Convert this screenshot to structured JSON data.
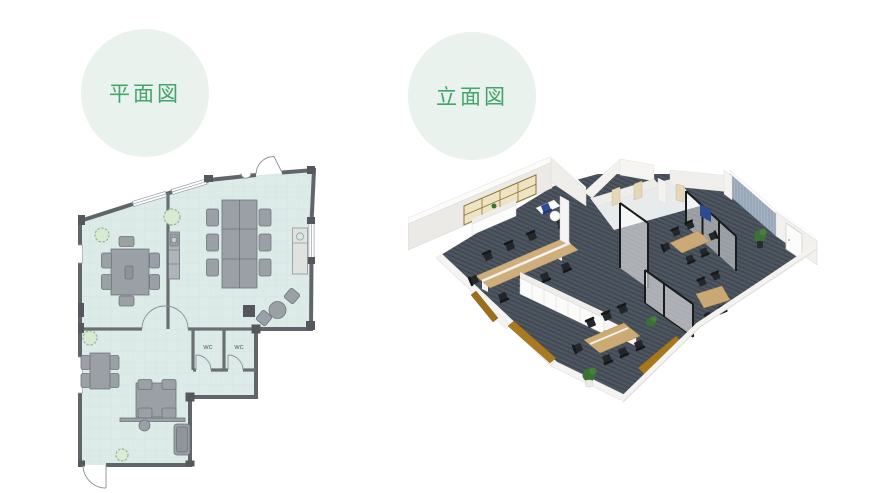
{
  "badges": {
    "bg_color": "#e9f2ed",
    "text_color": "#43a56b",
    "plan": {
      "label": "平面図"
    },
    "elevation": {
      "label": "立面図"
    }
  },
  "floor_plan": {
    "wc_label_1": "WC",
    "wc_label_2": "WC",
    "colors": {
      "floor": "#dcebe7",
      "grid": "#cfe2dd",
      "wall": "#60656a",
      "wall_nub": "#54585e",
      "furniture": "#9aa0a6",
      "furniture_outline": "#6e747a",
      "counter": "#dfe2df",
      "plant": "#d8ead2",
      "door_arc": "#8a9096"
    }
  },
  "elevation_view": {
    "colors": {
      "carpet": "#49525c",
      "carpet_streak": "#3e454e",
      "wall_face": "#eceae7",
      "wall_top": "#fbfbfa",
      "cabinet": "#fbfbfa",
      "wood_table": "#cfae7e",
      "window_frame": "#8e7330",
      "window_fill": "#eee3c4",
      "floor_panel_brown": "#a8761d",
      "glass_frame": "#1a1b1d",
      "accent_wall_blue": "#a5b4c4",
      "chair_black": "#23262b",
      "chair_blue": "#2e4d96",
      "plant_green": "#3c7035"
    }
  }
}
